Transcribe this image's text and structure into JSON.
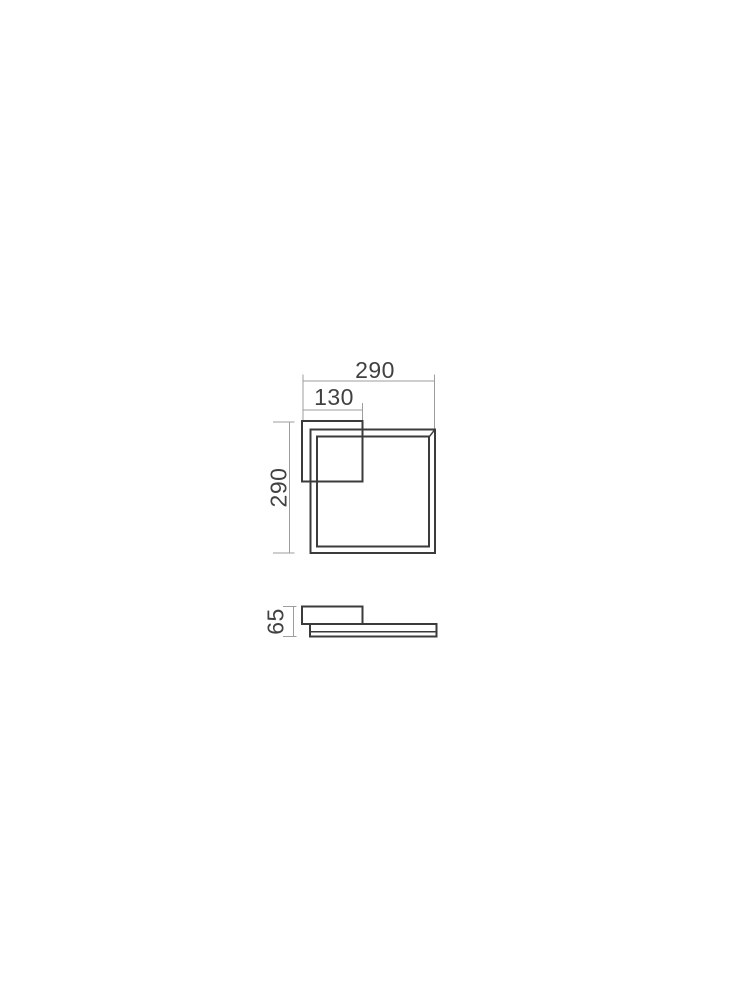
{
  "drawing": {
    "title": "square wall lamp dimension drawing",
    "views": [
      "front view",
      "side view"
    ],
    "colors": {
      "background": "#ffffff",
      "object_line": "#3b3b3b",
      "dimension_line": "#9d9d9d",
      "label_text": "#414141"
    },
    "front_view": {
      "width_label": "290",
      "height_label": "290",
      "backplate_width_label": "130"
    },
    "side_view": {
      "depth_label": "65"
    }
  }
}
